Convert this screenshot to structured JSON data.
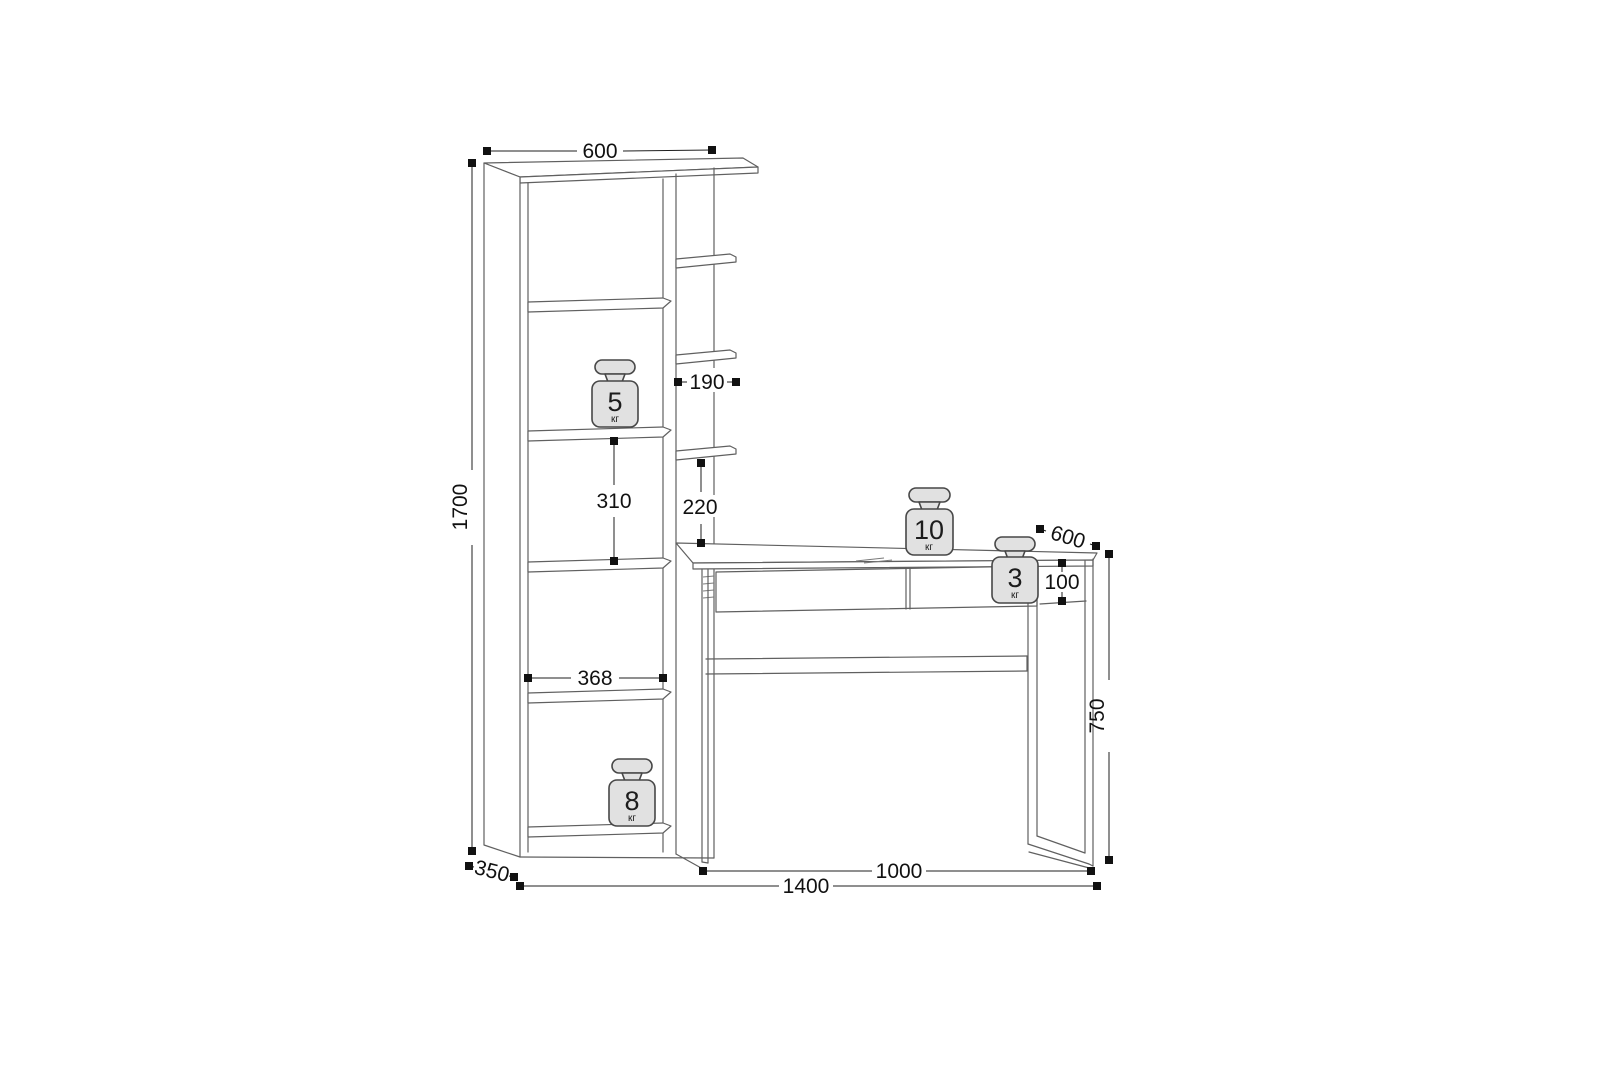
{
  "drawing": {
    "dimensions": {
      "top_width": "600",
      "total_height": "1700",
      "side_shelf_width": "190",
      "shelf_gap": "310",
      "side_shelf_gap": "220",
      "inner_shelf_width": "368",
      "shelf_depth": "350",
      "desk_depth": "600",
      "drawer_height": "100",
      "desk_height": "750",
      "desk_width": "1000",
      "total_width": "1400"
    },
    "weights": {
      "shelf_upper": {
        "value": "5",
        "unit": "кг"
      },
      "shelf_lower": {
        "value": "8",
        "unit": "кг"
      },
      "desktop": {
        "value": "10",
        "unit": "кг"
      },
      "drawer": {
        "value": "3",
        "unit": "кг"
      }
    },
    "colors": {
      "background": "#ffffff",
      "furniture_line": "#606060",
      "dimension_line": "#1f1f1f",
      "weight_fill": "#e1e1e1",
      "weight_stroke": "#474747",
      "text": "#111111"
    }
  }
}
